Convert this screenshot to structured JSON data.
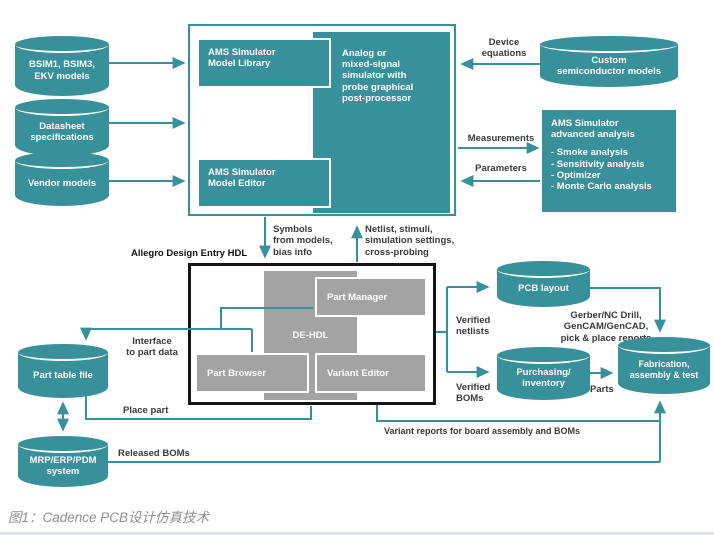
{
  "colors": {
    "teal": "#38909a",
    "gray": "#a3a3a3"
  },
  "caption": "图1：Cadence PCB设计仿真技术",
  "cylinders": {
    "bsim": "BSIM1, BSIM3,\nEKV models",
    "datasheet": "Datasheet\nspecifications",
    "vendor": "Vendor models",
    "custom": "Custom\nsemiconductor models",
    "pcb_layout": "PCB layout",
    "purchasing": "Purchasing/\ninventory",
    "fabrication": "Fabrication,\nassembly & test",
    "part_table": "Part table file",
    "mrp": "MRP/ERP/PDM\nsystem"
  },
  "sim_block": {
    "model_library": "AMS Simulator\nModel Library",
    "simulator": "Analog or\nmixed-signal\nsimulator with\nprobe graphical\npost-processor",
    "model_editor": "AMS Simulator\nModel Editor"
  },
  "advanced": {
    "title": "AMS Simulator\nadvanced analysis",
    "items": "- Smoke analysis\n- Sensitivity analysis\n- Optimizer\n- Monte Carlo analysis"
  },
  "hdl_block": {
    "title": "Allegro Design Entry HDL",
    "de_hdl": "DE-HDL",
    "part_manager": "Part Manager",
    "part_browser": "Part Browser",
    "variant_editor": "Variant Editor"
  },
  "flow_labels": {
    "device_equations": "Device\nequations",
    "measurements": "Measurements",
    "parameters": "Parameters",
    "symbols": "Symbols\nfrom models,\nbias info",
    "netlist": "Netlist, stimuli,\nsimulation settings,\ncross-probing",
    "interface": "Interface\nto part data",
    "place_part": "Place part",
    "released_boms": "Released BOMs",
    "variant_reports": "Variant reports for board assembly and BOMs",
    "verified_netlists": "Verified\nnetlists",
    "verified_boms": "Verified\nBOMs",
    "gerber": "Gerber/NC Drill,\nGenCAM/GenCAD,\npick & place reports",
    "parts": "Parts"
  }
}
